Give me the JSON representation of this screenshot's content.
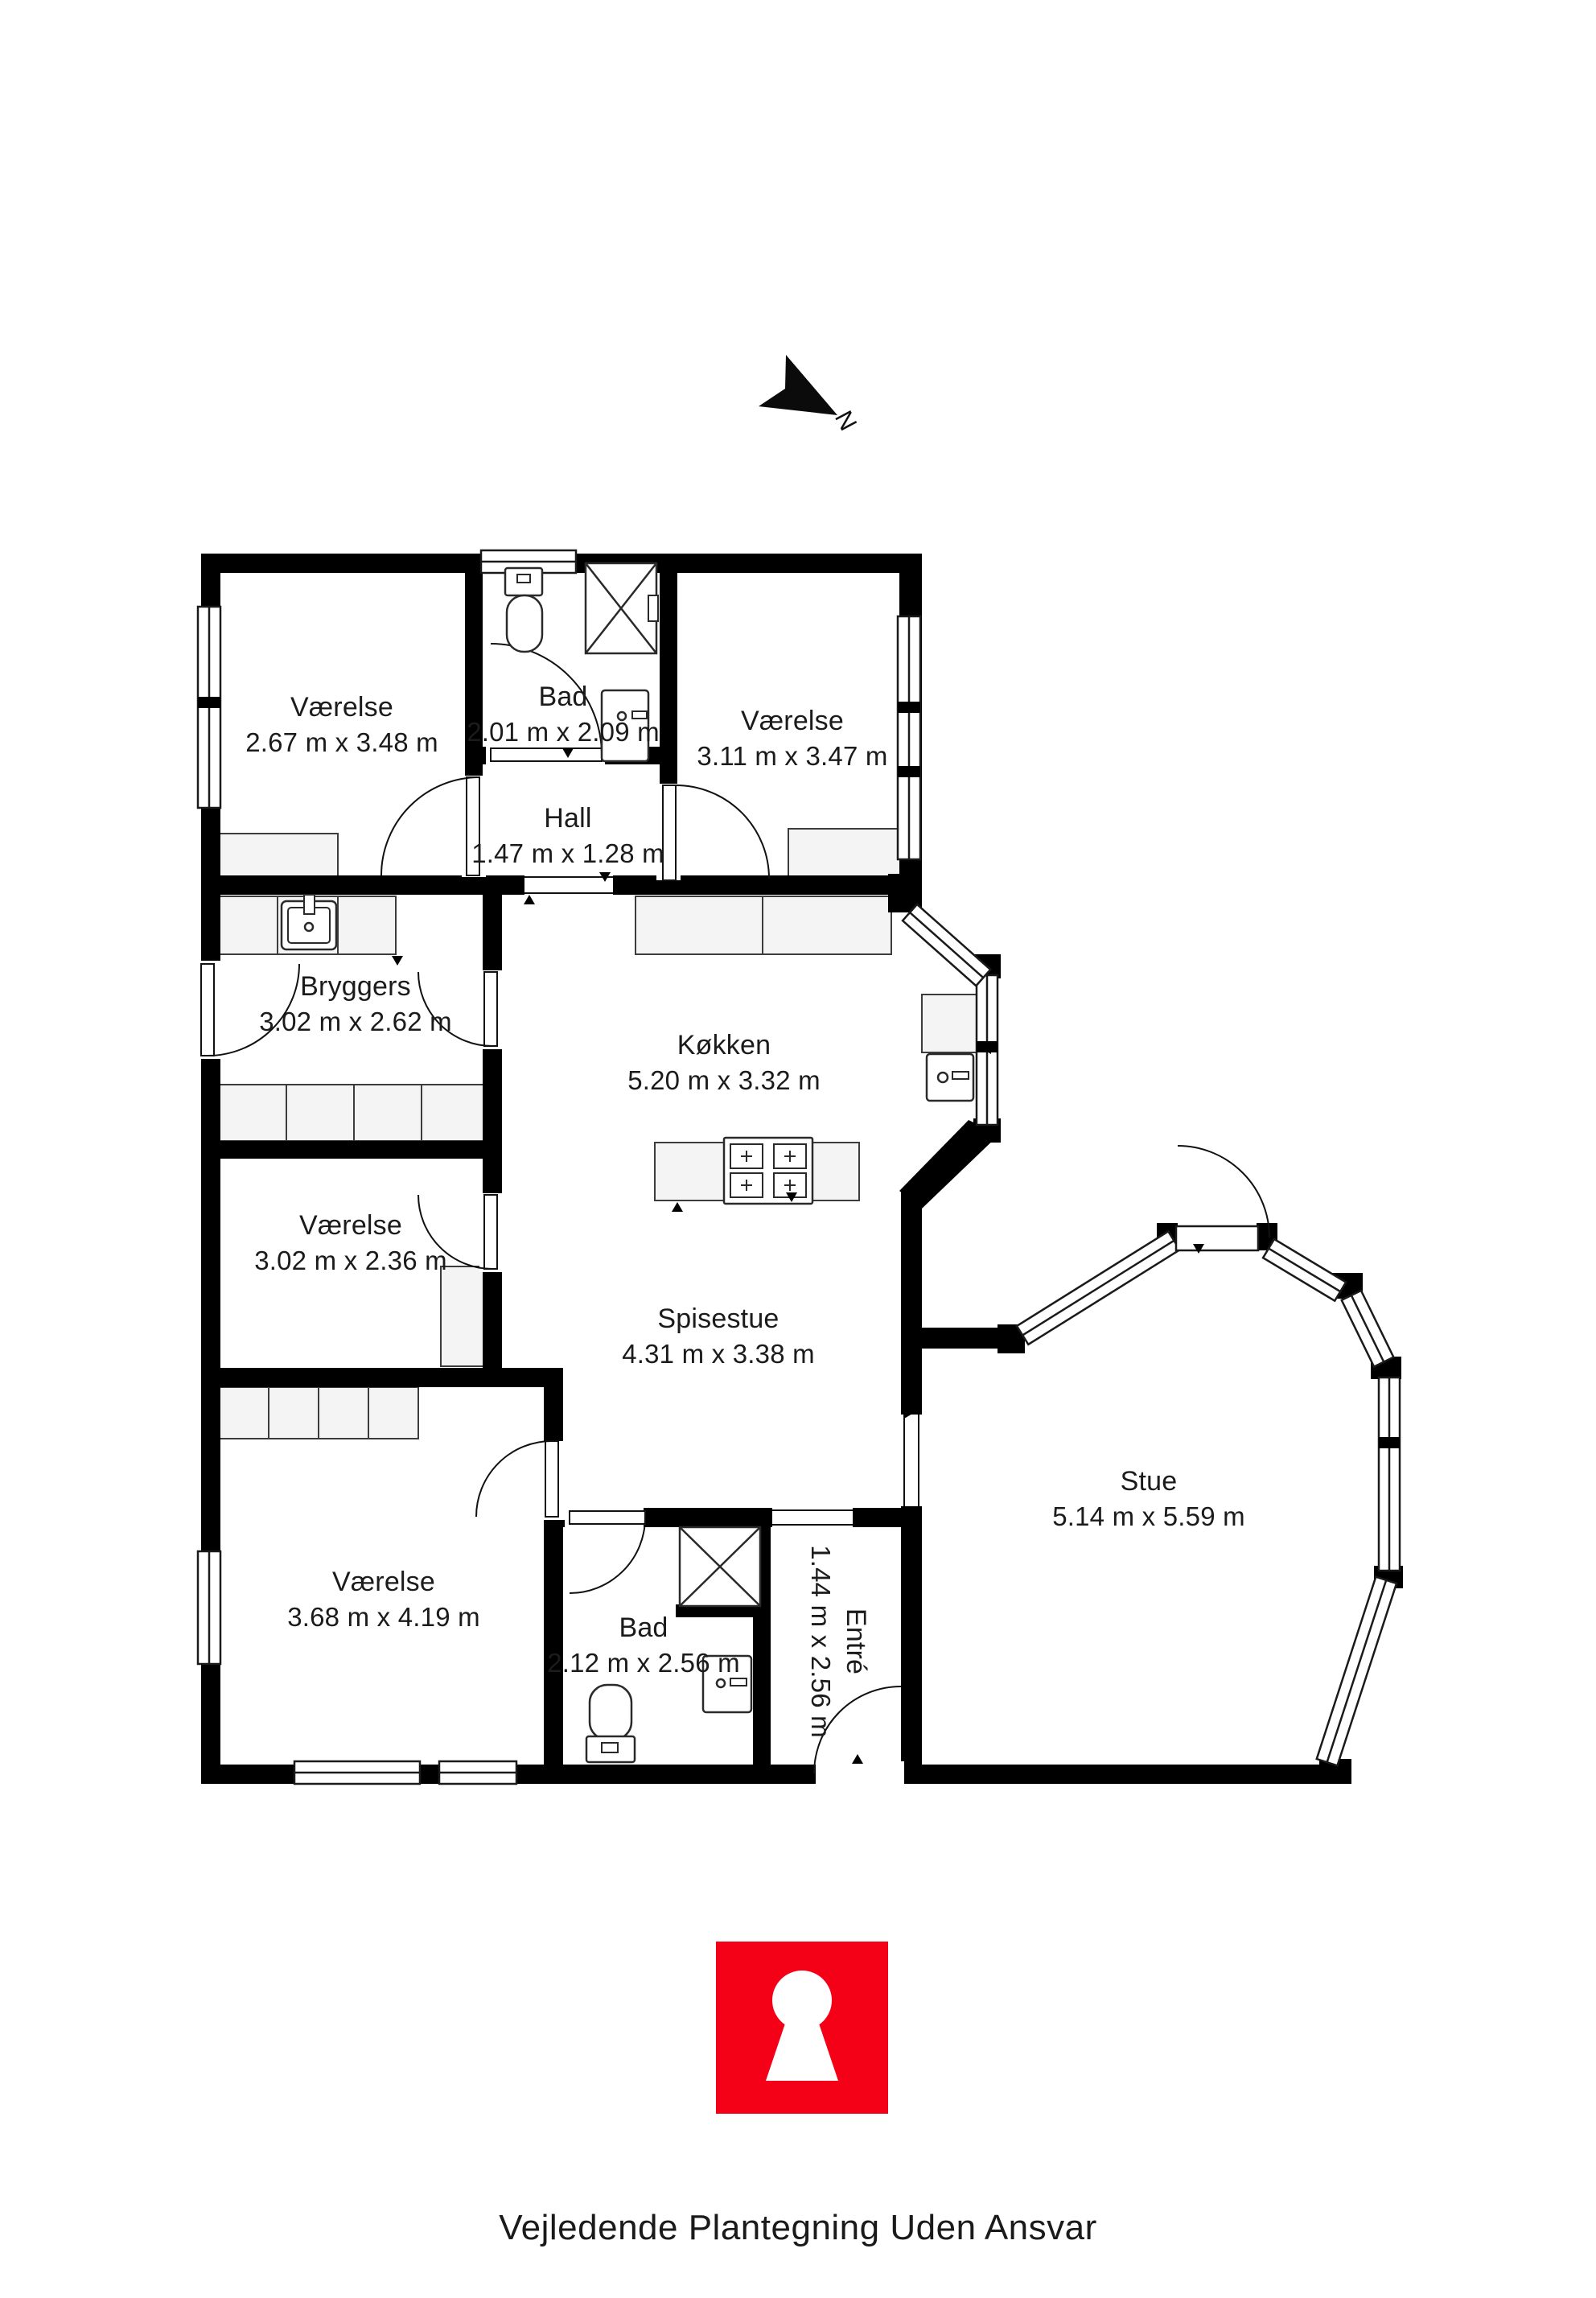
{
  "north": {
    "label": "N"
  },
  "rooms": {
    "vaerelse_nw": {
      "name": "Værelse",
      "dims": "2.67 m x 3.48 m"
    },
    "bad_top": {
      "name": "Bad",
      "dims": "2.01 m x 2.09 m"
    },
    "vaerelse_ne": {
      "name": "Værelse",
      "dims": "3.11 m x 3.47 m"
    },
    "hall": {
      "name": "Hall",
      "dims": "1.47 m x 1.28 m"
    },
    "bryggers": {
      "name": "Bryggers",
      "dims": "3.02 m x 2.62 m"
    },
    "koekken": {
      "name": "Køkken",
      "dims": "5.20 m x 3.32 m"
    },
    "vaerelse_w": {
      "name": "Værelse",
      "dims": "3.02 m x 2.36 m"
    },
    "spisestue": {
      "name": "Spisestue",
      "dims": "4.31 m x 3.38 m"
    },
    "stue": {
      "name": "Stue",
      "dims": "5.14 m x 5.59 m"
    },
    "vaerelse_sw": {
      "name": "Værelse",
      "dims": "3.68 m x 4.19 m"
    },
    "bad_bottom": {
      "name": "Bad",
      "dims": "2.12 m x 2.56 m"
    },
    "entre": {
      "name": "Entré",
      "dims": "1.44 m x 2.56 m"
    }
  },
  "footer": {
    "disclaimer": "Vejledende Plantegning Uden Ansvar"
  },
  "logo": {
    "icon": "keyhole",
    "color": "#f40117"
  },
  "colors": {
    "wall": "#000000",
    "furniture": "#f4f4f4",
    "text": "#1b1b1b"
  }
}
